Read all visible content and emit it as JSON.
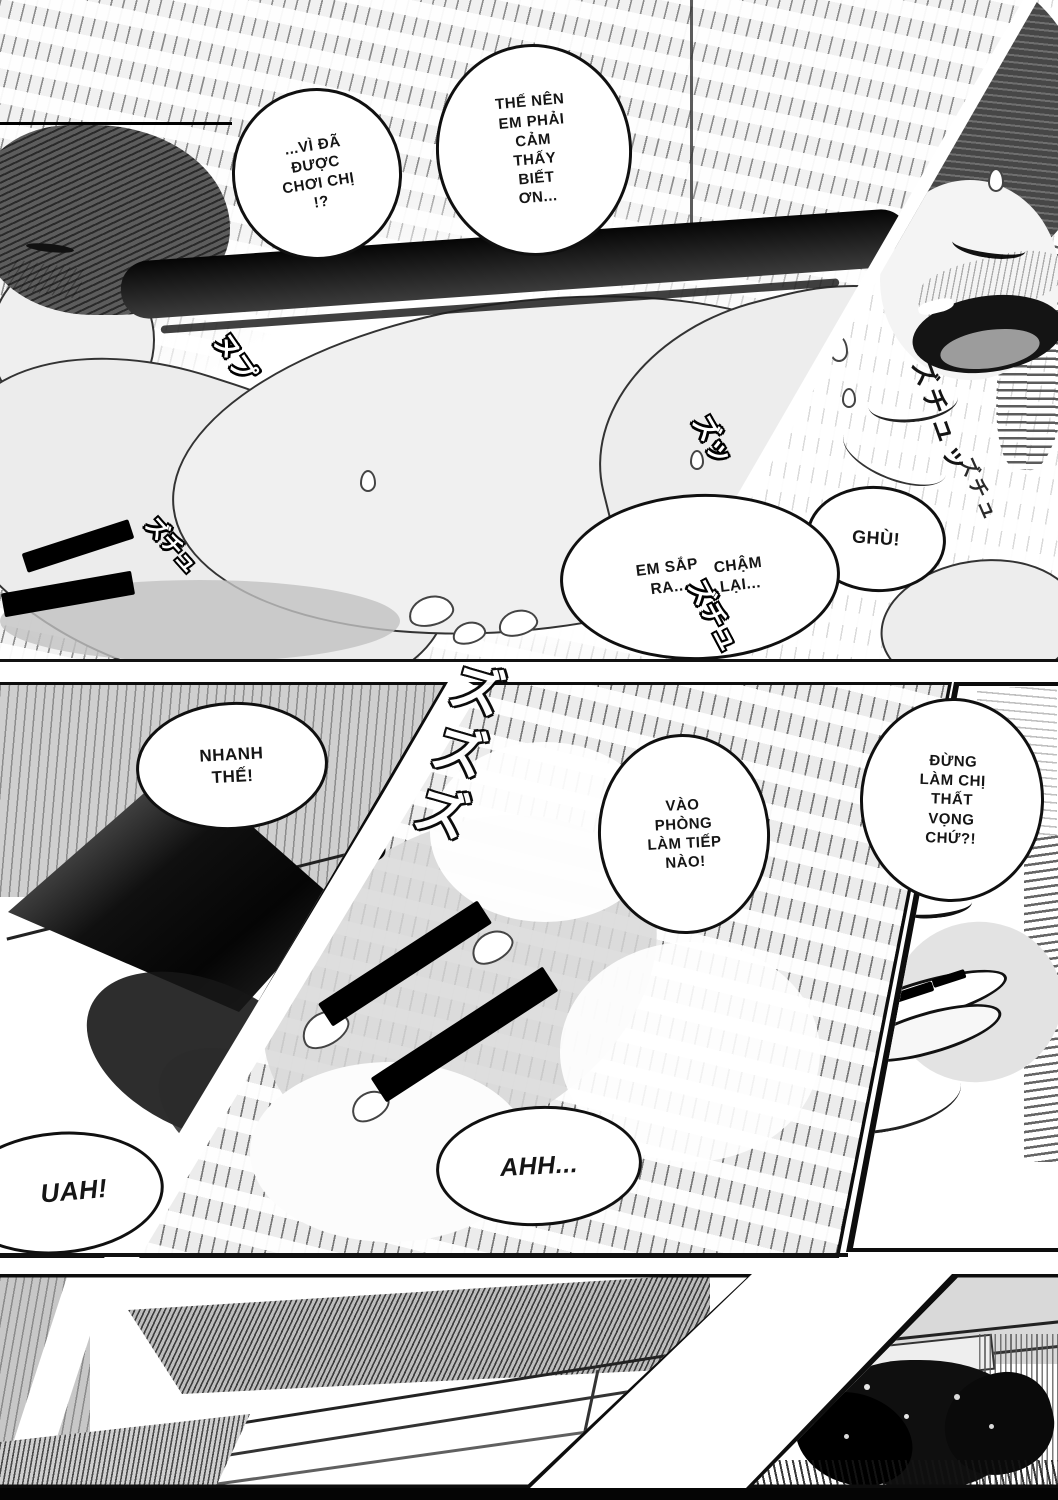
{
  "comic": {
    "bubbles": {
      "b1": {
        "lines": [
          "...VÌ ĐÃ",
          "ĐƯỢC",
          "CHƠI CHỊ",
          "!?"
        ]
      },
      "b2": {
        "lines": [
          "THẾ NÊN",
          "EM PHẢI",
          "CẢM",
          "THẤY",
          "BIẾT",
          "ƠN..."
        ]
      },
      "b3a": {
        "lines": [
          "EM SẮP",
          "RA..."
        ]
      },
      "b3b": {
        "lines": [
          "CHẬM",
          "LẠI..."
        ]
      },
      "b4": {
        "lines": [
          "GHÙ!"
        ]
      },
      "b5": {
        "lines": [
          "NHANH",
          "THẾ!"
        ]
      },
      "b6": {
        "lines": [
          "VÀO",
          "PHÒNG",
          "LÀM TIẾP",
          "NÀO!"
        ]
      },
      "b7": {
        "lines": [
          "ĐỪNG",
          "LÀM CHỊ",
          "THẤT",
          "VỌNG",
          "CHỨ?!"
        ]
      },
      "b8": {
        "lines": [
          "AHH..."
        ]
      },
      "b9": {
        "lines": [
          "UAH!"
        ]
      }
    },
    "sfx": {
      "s1": "ズプ",
      "s2": "ヌプ",
      "s3": "ズチュ",
      "s4": "ズズズ",
      "s5": "グチュ",
      "s6": "ズッ",
      "s7": "ピクッ",
      "s8": "ズチュッ",
      "s9": "ズチュ"
    },
    "colors": {
      "paper": "#ffffff",
      "ink": "#111111",
      "tone_light": "#e6e6e6",
      "tone_mid": "#bfbfbf",
      "tone_dark": "#4a4a4a",
      "censor": "#000000"
    }
  }
}
